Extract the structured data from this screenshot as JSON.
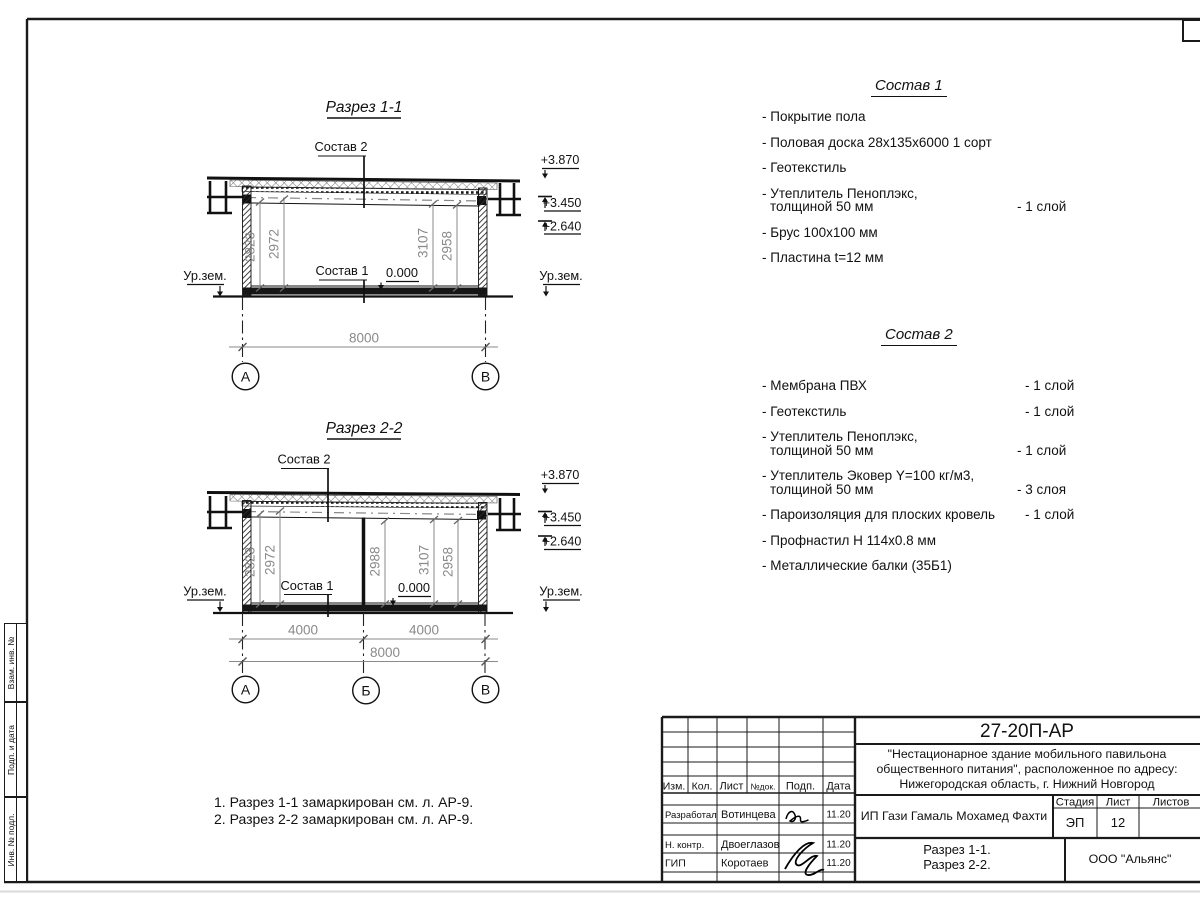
{
  "drawing": {
    "section1": {
      "title": "Разрез 1-1",
      "sostav2_label": "Состав 2",
      "sostav1_label": "Состав 1",
      "zero_level": "0.000",
      "ground_left": "Ур.зем.",
      "ground_right": "Ур.зем.",
      "elev_top": "+3.870",
      "elev_mid": "+3.450",
      "elev_low": "+2.640",
      "dim1": "2823",
      "dim2": "2972",
      "dim3": "3107",
      "dim4": "2958",
      "dim_total": "8000",
      "axis_a": "А",
      "axis_b": "В"
    },
    "section2": {
      "title": "Разрез 2-2",
      "sostav2_label": "Состав 2",
      "sostav1_label": "Состав 1",
      "zero_level": "0.000",
      "ground_left": "Ур.зем.",
      "ground_right": "Ур.зем.",
      "elev_top": "+3.870",
      "elev_mid": "+3.450",
      "elev_low": "+2.640",
      "dim1": "2823",
      "dim2": "2972",
      "dim3": "2988",
      "dim4": "3107",
      "dim5": "2958",
      "span1": "4000",
      "span2": "4000",
      "dim_total": "8000",
      "axis_a": "А",
      "axis_b": "Б",
      "axis_c": "В"
    }
  },
  "sostav1": {
    "title": "Состав 1",
    "items": [
      {
        "line1": "- Покрытие пола"
      },
      {
        "line1": "- Половая доска 28х135х6000 1 сорт"
      },
      {
        "line1": "- Геотекстиль"
      },
      {
        "line1": "- Утеплитель Пеноплэкс,",
        "line2": "толщиной 50 мм",
        "qty": "- 1 слой"
      },
      {
        "line1": "- Брус 100х100 мм"
      },
      {
        "line1": "- Пластина t=12 мм"
      }
    ]
  },
  "sostav2": {
    "title": "Состав 2",
    "items": [
      {
        "line1": "- Мембрана ПВХ",
        "qty": "- 1 слой"
      },
      {
        "line1": "- Геотекстиль",
        "qty": "- 1 слой"
      },
      {
        "line1": "- Утеплитель Пеноплэкс,",
        "line2": "толщиной 50 мм",
        "qty": "- 1 слой"
      },
      {
        "line1": "- Утеплитель Эковер Y=100 кг/м3,",
        "line2": "толщиной 50 мм",
        "qty": "- 3 слоя"
      },
      {
        "line1": "- Пароизоляция для плоских кровель",
        "qty": "- 1 слой"
      },
      {
        "line1": "- Профнастил Н 114х0.8 мм"
      },
      {
        "line1": "- Металлические балки (35Б1)"
      }
    ]
  },
  "notes": {
    "line1": "1. Разрез 1-1 замаркирован см. л. АР-9.",
    "line2": "2. Разрез 2-2 замаркирован см. л. АР-9."
  },
  "titleblock": {
    "doc_number": "27-20П-АР",
    "project_line1": "\"Нестационарное здание мобильного павильона",
    "project_line2": "общественного питания\", расположенное по адресу:",
    "project_line3": "Нижегородская область, г. Нижний Новгород",
    "col_izm": "Изм.",
    "col_kol": "Кол.",
    "col_list": "Лист",
    "col_ndok": "№док.",
    "col_podp": "Подп.",
    "col_data": "Дата",
    "row1_role": "Разработал",
    "row1_name": "Вотинцева",
    "row1_date": "11.20",
    "row2_role": "Н. контр.",
    "row2_name": "Двоеглазов",
    "row2_date": "11.20",
    "row3_role": "ГИП",
    "row3_name": "Коротаев",
    "row3_date": "11.20",
    "client": "ИП Гази Гамаль Мохамед Фахти",
    "stage_label": "Стадия",
    "list_label": "Лист",
    "listov_label": "Листов",
    "stage_value": "ЭП",
    "list_value": "12",
    "listov_value": "",
    "subject_line1": "Разрез 1-1.",
    "subject_line2": "Разрез 2-2.",
    "company": "ООО \"Альянс\""
  },
  "side_column": {
    "cell1": "Взам. инв. №",
    "cell2": "Подп. и дата",
    "cell3": "Инв. № подл."
  }
}
